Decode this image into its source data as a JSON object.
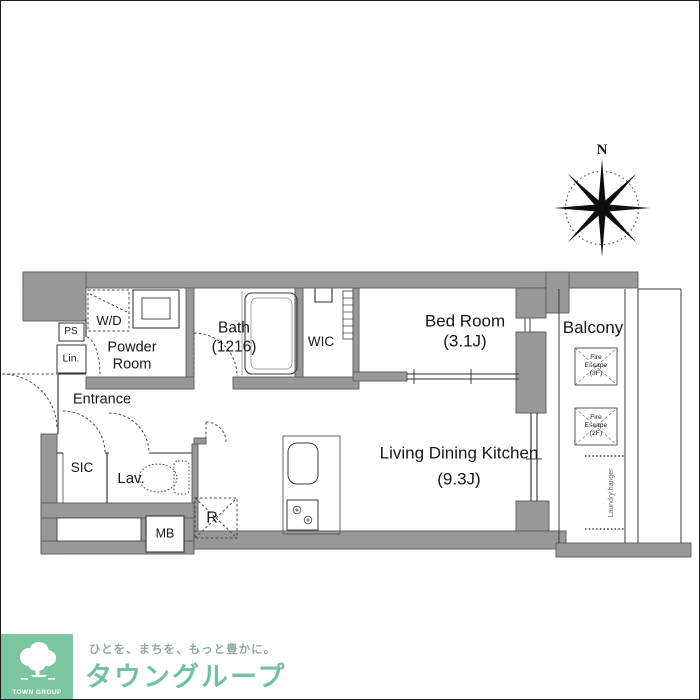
{
  "compass": {
    "north_label": "N"
  },
  "rooms": {
    "wd": {
      "label": "W/D"
    },
    "ps": {
      "label": "PS"
    },
    "lin": {
      "label": "Lin."
    },
    "powder": {
      "line1": "Powder",
      "line2": "Room"
    },
    "bath": {
      "line1": "Bath",
      "line2": "(1216)"
    },
    "wic": {
      "label": "WIC"
    },
    "bedroom": {
      "line1": "Bed Room",
      "line2": "(3.1J)"
    },
    "balcony": {
      "label": "Balcony"
    },
    "fire_escape_3f": {
      "line1": "Fire",
      "line2": "Escape",
      "line3": "(3F)"
    },
    "fire_escape_2f": {
      "line1": "Fire",
      "line2": "Escape",
      "line3": "(2F)"
    },
    "laundry_hanger": {
      "label": "Laundry hanger"
    },
    "entrance": {
      "label": "Entrance"
    },
    "sic": {
      "label": "SIC"
    },
    "lav": {
      "label": "Lav."
    },
    "mb": {
      "label": "MB"
    },
    "r": {
      "label": "R"
    },
    "ldk": {
      "line1": "Living Dining Kitchen",
      "line2": "(9.3J)"
    }
  },
  "branding": {
    "logo_text": "TOWN GROUP",
    "tagline": "ひとを、まちを、もっと豊かに。",
    "company": "タウングループ"
  },
  "colors": {
    "wall_gray": "#989898",
    "line_dark": "#2c2c2c",
    "logo_green": "#7cc5a0",
    "company_green": "#74c19e",
    "tagline_gray": "#94a8a1"
  }
}
